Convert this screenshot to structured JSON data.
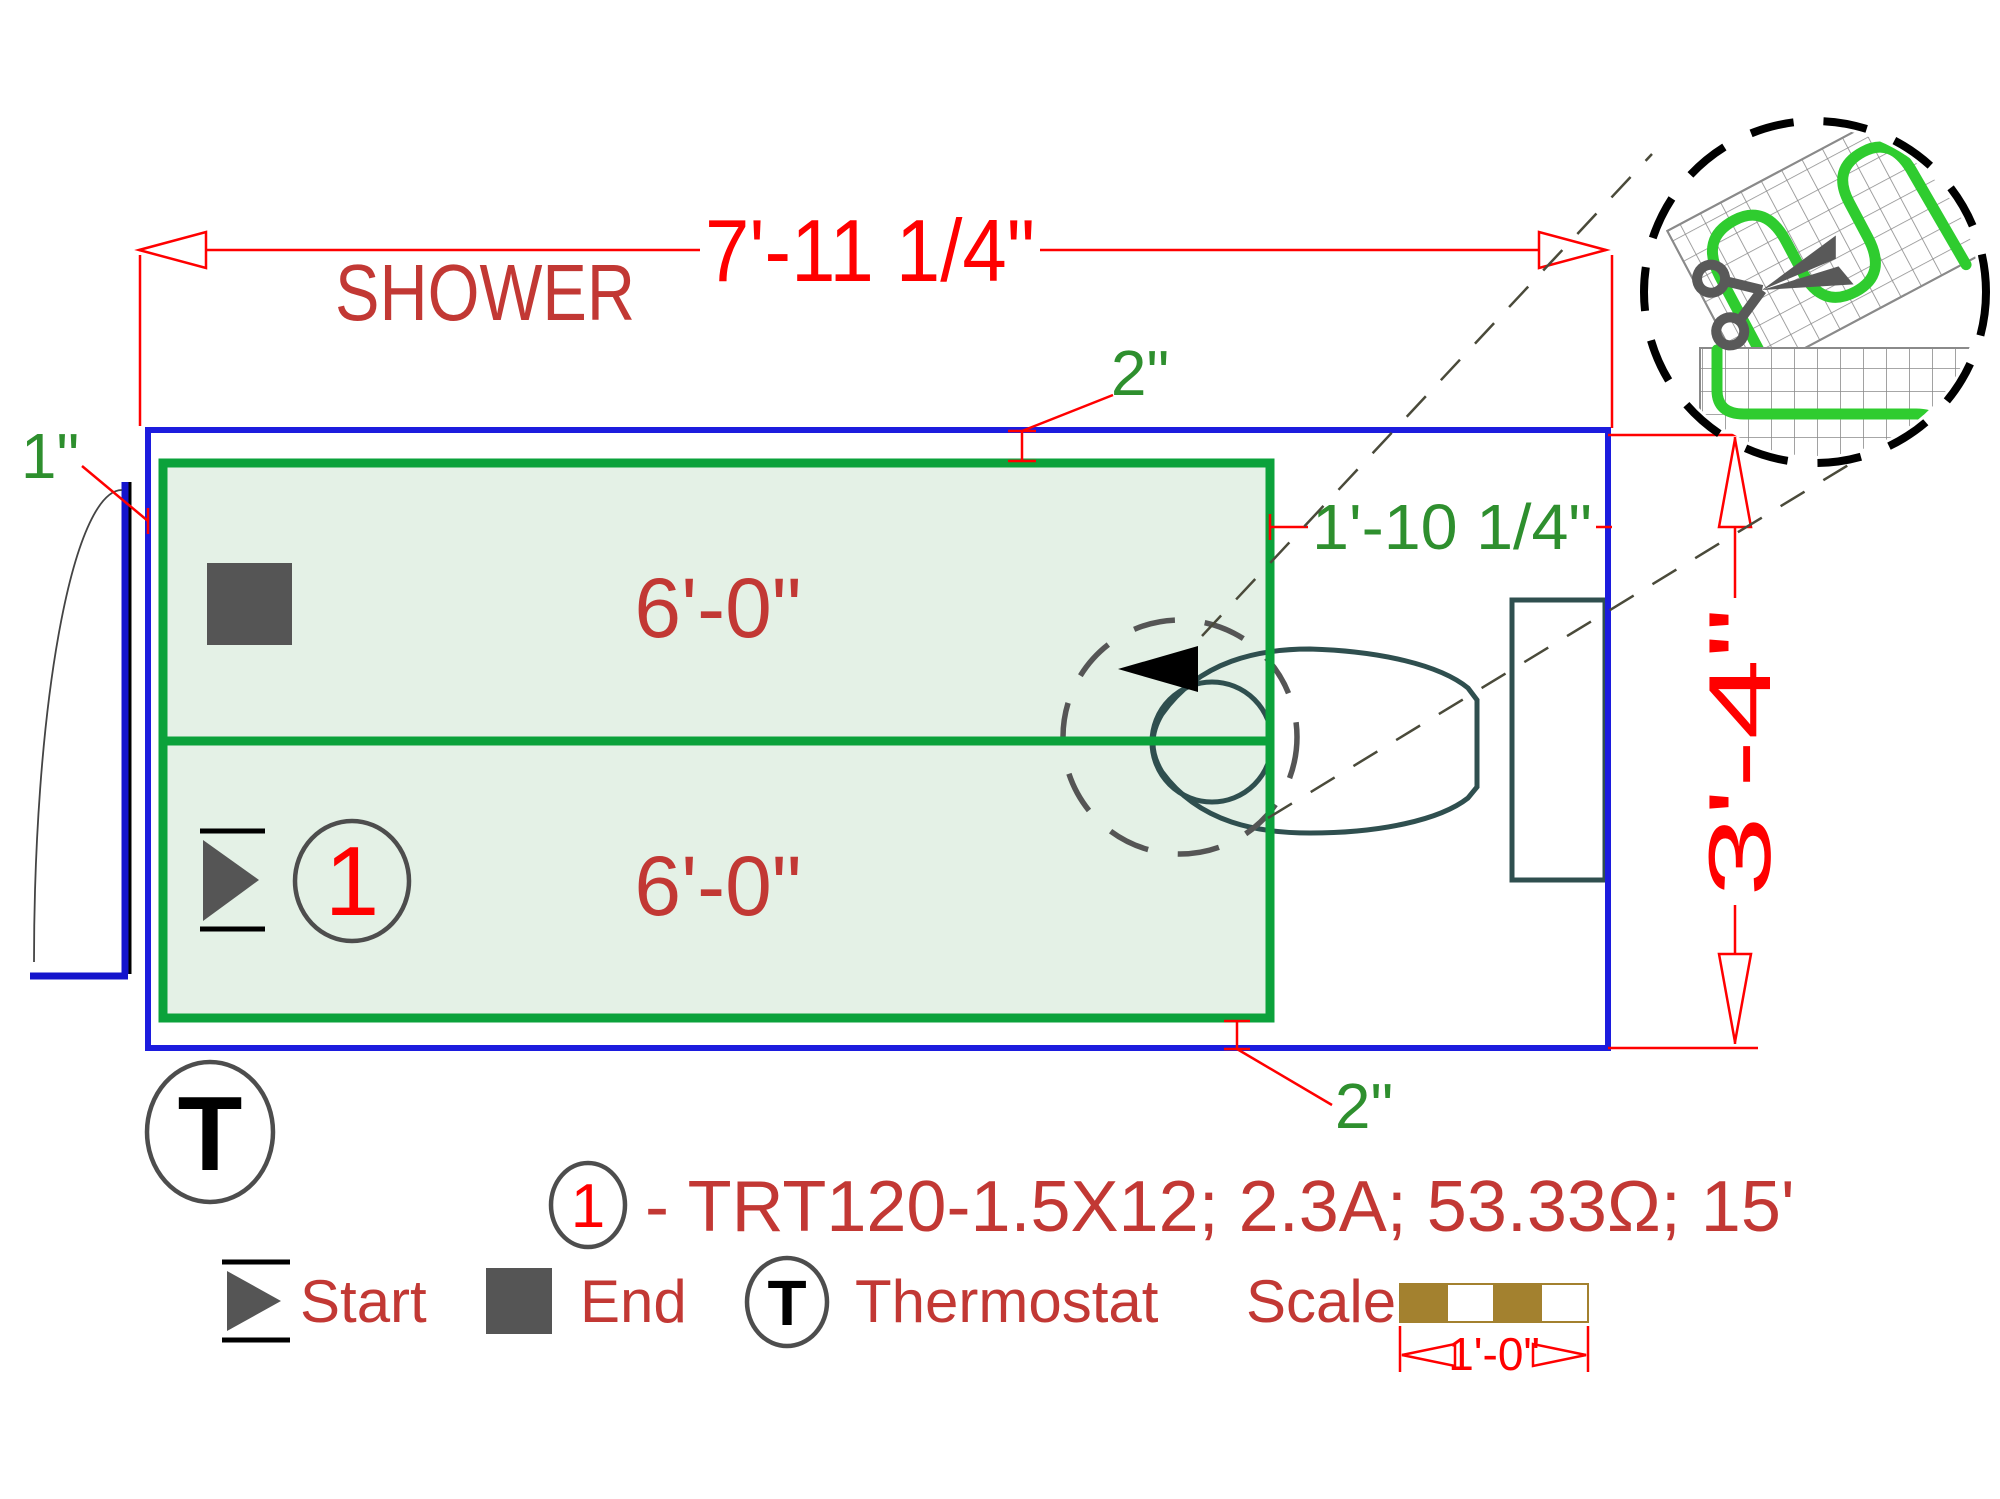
{
  "title": "SHOWER",
  "dimensions": {
    "overall_width": "7'-11 1/4\"",
    "overall_height": "3'-4\"",
    "right_gap": "1'-10 1/4\"",
    "top_gap": "2\"",
    "bottom_gap": "2\"",
    "left_gap": "1\""
  },
  "mat": {
    "row1_length": "6'-0\"",
    "row2_length": "6'-0\"",
    "circuit_number": "1"
  },
  "thermostat": {
    "symbol": "T"
  },
  "callout": {
    "number": "1",
    "spec": "- TRT120-1.5X12; 2.3A; 53.33Ω; 15'"
  },
  "legend": {
    "start_label": "Start",
    "end_label": "End",
    "thermostat_symbol": "T",
    "thermostat_label": "Thermostat",
    "scale_label": "Scale",
    "scale_value": "1'-0\""
  },
  "icons": {
    "scissors": "scissors-icon",
    "start_marker": "start-arrow-icon",
    "end_marker": "end-square-icon",
    "direction_arrow": "cable-direction-arrow-icon"
  },
  "colors": {
    "dimension_red": "#FF0000",
    "label_red": "#C23834",
    "label_green": "#2E8F2E",
    "mat_green": "#0BA23B",
    "mat_fill": "#E4F1E6",
    "wall_blue": "#1C1CDE",
    "cable_green": "#2FCC2F",
    "symbol_gray": "#555555",
    "fixture_slate": "#2F4F4F",
    "scale_gold": "#A3812F"
  }
}
